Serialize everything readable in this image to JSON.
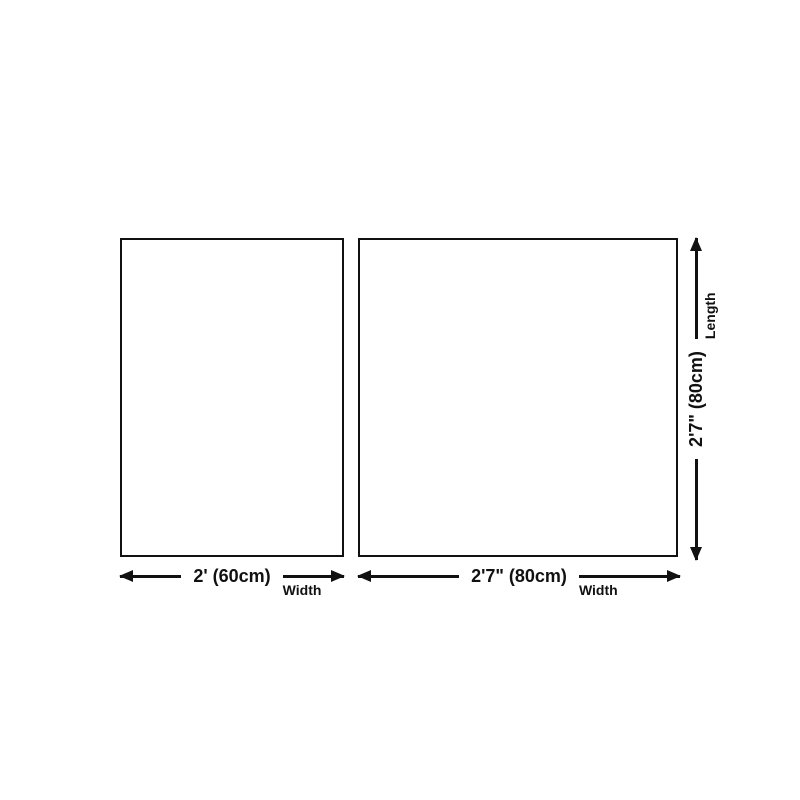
{
  "diagram": {
    "colors": {
      "ink": "#111111",
      "bg": "#ffffff"
    },
    "panels": [
      {
        "id": "small-panel",
        "width": {
          "value": "2' (60cm)",
          "label": "Width"
        }
      },
      {
        "id": "large-panel",
        "width": {
          "value": "2'7\" (80cm)",
          "label": "Width"
        },
        "length": {
          "value": "2'7\" (80cm)",
          "label": "Length"
        }
      }
    ]
  }
}
